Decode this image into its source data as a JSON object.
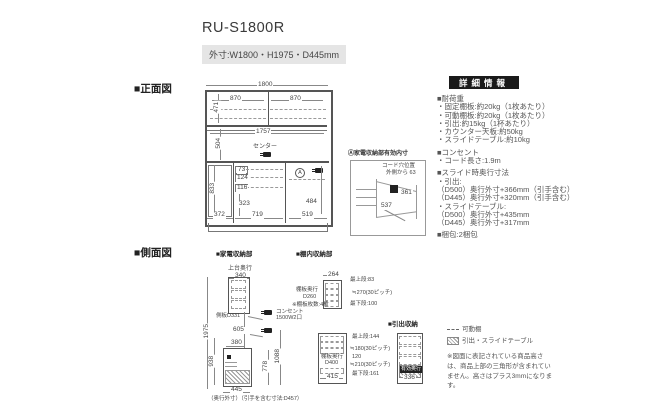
{
  "header": {
    "title": "RU-S1800R",
    "outer_dims": "外寸:W1800・H1975・D445mm"
  },
  "front_view": {
    "label": "■正面図",
    "dim_total_width": "1800",
    "dim_shelf_left": "870",
    "dim_shelf_right": "870",
    "dim_upper_height": "471",
    "dim_counter_width": "1757",
    "dim_counter_height": "504",
    "center_label": "センター",
    "dim_left_width": "372",
    "dim_left_height": "833",
    "dim_drawer1": "73",
    "dim_drawer2": "124",
    "dim_drawer3": "116",
    "dim_open": "323",
    "dim_mid_width": "719",
    "dim_right_width": "519",
    "dim_right_height": "484",
    "marker_a": "A"
  },
  "appliance_inset": {
    "title": "Ⓐ家電収納部有効内寸",
    "cord_line1": "コード穴位置",
    "cord_line2": "外側から 63",
    "dim_width": "361",
    "dim_depth": "537"
  },
  "details": {
    "header": "詳細情報",
    "load": {
      "heading": "■耐荷重",
      "lines": [
        "・固定棚板:約20kg（1枚あたり）",
        "・可動棚板:約20kg（1枚あたり）",
        "・引出:約15kg（1杯あたり）",
        "・カウンター天板:約50kg",
        "・スライドテーブル:約10kg"
      ]
    },
    "outlet": {
      "heading": "■コンセント",
      "lines": [
        "・コード長さ:1.9m"
      ]
    },
    "slide": {
      "heading": "■スライド時奥行寸法",
      "lines": [
        "・引出:",
        "（D500）奥行外寸+366mm（引手含む）",
        "（D445）奥行外寸+320mm（引手含む）",
        "・スライドテーブル:",
        "（D500）奥行外寸+435mm",
        "（D445）奥行外寸+317mm"
      ]
    },
    "packing": {
      "heading": "■梱包:2梱包"
    }
  },
  "side_view": {
    "label": "■側面図",
    "appliance_label": "■家電収納部",
    "top_depth_label": "上台奥行",
    "dim_top_depth": "340",
    "shelf_depth_label": "側板D331",
    "dim_total_height": "1975",
    "dim_gap": "605",
    "dim_lower_top": "380",
    "dim_lower_height": "938",
    "dim_inner_height": "778",
    "dim_right_height": "1088",
    "outlet_line1": "コンセント",
    "outlet_line2": "1500W2口",
    "dim_bottom_depth": "445",
    "bottom_note": "（奥行外寸）（引手を含む寸法:D457）"
  },
  "shelf_upper": {
    "label": "■棚内収納部",
    "dim_width": "264",
    "depth_line1": "棚板奥行",
    "depth_line2": "D260",
    "count_note": "※棚板枚数:4枚",
    "dim_top": "最上段:83",
    "dim_pitch": "≒270(30ピッチ)",
    "dim_bottom": "最下段:100"
  },
  "shelf_lower": {
    "depth_line1": "棚板奥行",
    "depth_line2": "D400",
    "dim_width": "415",
    "dim_top": "最上段:144",
    "dim_pitch1": "≒180(30ピッチ)",
    "dim_mid": "120",
    "dim_pitch2": "≒210(30ピッチ)",
    "dim_bottom": "最下段:161"
  },
  "drawer_unit": {
    "label": "■引出収納",
    "inner_label": "有効奥行",
    "dim_width": "336"
  },
  "legend": {
    "movable": "可動棚",
    "slide": "引出・スライドテーブル"
  },
  "footnote": "※図面に表記されている商品高さは、商品上部の三角形が含まれていません。高さはプラス3mmになります。",
  "colors": {
    "panel_header_bg": "#1a1a1a",
    "panel_header_fg": "#ffffff",
    "badge_bg": "#e5e5e5",
    "line_dark": "#555555",
    "line_mid": "#888888",
    "text": "#444444"
  }
}
